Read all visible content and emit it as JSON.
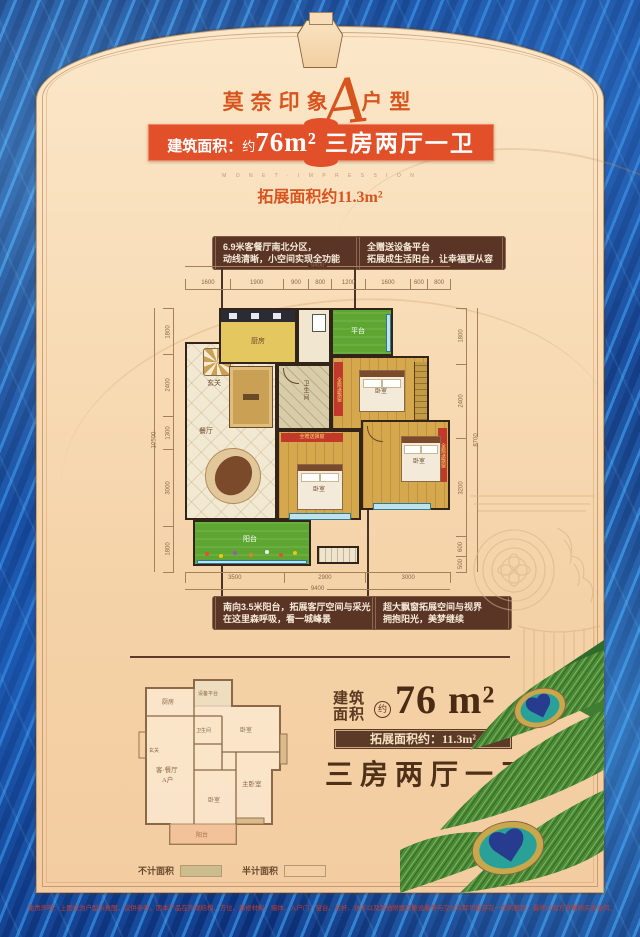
{
  "header": {
    "title_left": "莫奈印象",
    "title_letter": "A",
    "title_right": "户型",
    "banner_label": "建筑面积：",
    "banner_approx": "约",
    "banner_area": "76m²",
    "banner_type": "三房两厅一卫",
    "tagline": "M O N E T · I M P R E S S I O N",
    "expand_line": "拓展面积约11.3m²"
  },
  "callouts": {
    "top_left_1": "6.9米客餐厅南北分区，",
    "top_left_2": "动线清晰，小空间实现全功能",
    "top_right_1": "全赠送设备平台",
    "top_right_2": "拓展成生活阳台，让幸福更从容",
    "bottom_left_1": "南向3.5米阳台，拓展客厅空间与采光",
    "bottom_left_2": "在这里森呼吸，看一城峰景",
    "bottom_right_1": "超大飘窗拓展空间与视界",
    "bottom_right_2": "拥抱阳光，美梦继续"
  },
  "plan": {
    "rooms": {
      "entry": "玄关",
      "kitchen": "厨房",
      "platform": "平台",
      "dining": "餐厅",
      "bath": "卫生间",
      "bed": "卧室",
      "balcony": "阳台",
      "ribbon": "全赠送飘窗"
    },
    "dims": {
      "top_total": "9400",
      "top": [
        "1600",
        "1900",
        "900",
        "800",
        "1200",
        "1600",
        "600",
        "800"
      ],
      "left_total": "10500",
      "left": [
        "1800",
        "2400",
        "1300",
        "3000",
        "1800"
      ],
      "right_total": "8700",
      "right": [
        "1800",
        "2400",
        "3200",
        "600",
        "500"
      ],
      "bottom_total": "9400",
      "bottom": [
        "3500",
        "2900",
        "3000"
      ]
    }
  },
  "bottom": {
    "mini": {
      "kitchen": "厨房",
      "platform": "设备平台",
      "bath": "卫生间",
      "bed_small": "卧室",
      "living": "客·餐厅",
      "unit": "A户",
      "master": "主卧室",
      "bed2": "卧室",
      "balcony": "阳台",
      "entry": "玄关"
    },
    "legend": {
      "no_area": "不计面积",
      "half_area": "半计面积"
    },
    "build_1": "建筑",
    "build_2": "面积",
    "approx": "约",
    "area": "76 m²",
    "expand_badge": "拓展面积约：11.3m²",
    "type": "三房两厅一卫"
  },
  "footer": {
    "disclaimer": "免责声明：上图仅为户型示意图，仅供参考。因本产品在外观结构、方位、装修材料、墙体、入户门、窗台、栏杆、扶手以及其他附属设施设备等与交付实际可能存在一定的差异，最终以双方签署的买卖合同、政府核准文件及交付楼盘实际为准。"
  }
}
